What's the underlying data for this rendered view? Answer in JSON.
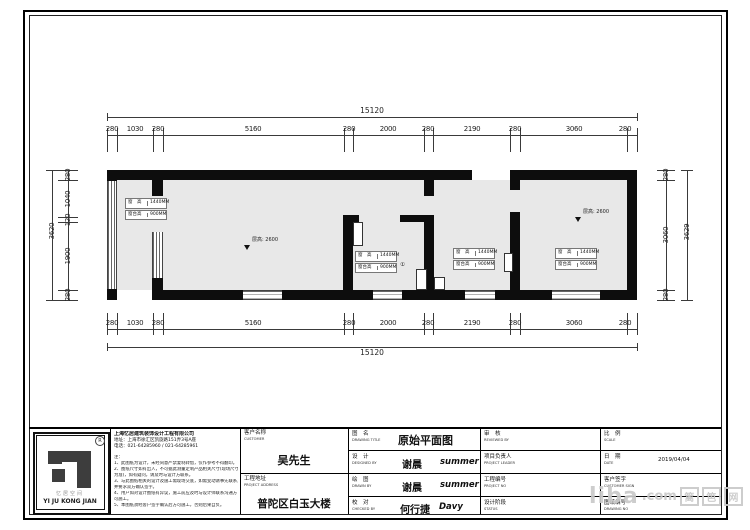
{
  "dims": {
    "h_total": "15120",
    "h_segments": [
      "280",
      "1030",
      "280",
      "5160",
      "280",
      "2000",
      "280",
      "2190",
      "280",
      "3060",
      "280"
    ],
    "v_left_total": "3620",
    "v_left_segments": [
      "280",
      "1040",
      "120",
      "1900",
      "280"
    ],
    "v_right_total": "3629",
    "v_right_segments": [
      "280",
      "3060",
      "280"
    ]
  },
  "plan": {
    "win_h": "窗　高",
    "win_h_val": "1440MM",
    "sill": "窗台高",
    "sill_val": "900MM",
    "ceiling": "层高: 2600",
    "circle": "①"
  },
  "titleblock": {
    "logo": {
      "reg": "R",
      "cn": "忆居空间",
      "en": "YI JU KONG JIAN"
    },
    "company": {
      "name": "上海忆居建筑装饰设计工程有限公司",
      "address": "地址：上海市徐汇区凯旋路151弄3号A座",
      "phone": "电话：021-64285960 / 021-64285961",
      "notes_title": "注：",
      "notes": [
        "1、此图纸为设计，未经同意严禁复制转借，仅作参考不得翻印。",
        "2、图纸尺寸如有出入，不可据此测量定制产品相关尺寸(现场尺寸",
        "为准)，如有疑问，请及时与设计方联系。",
        "3、与此图纸相关的设计及施工需现场交底，如需变动请事先联系，",
        "并要求双方确认签字。",
        "4、用户如对设计图纸有异议，施工前应及时与设计师联系沟通方",
        "可施工。",
        "5、本图纸须经客户签字确认后方可施工，否则后果自负。"
      ]
    },
    "customer": {
      "label_cn": "客户名称",
      "label_en": "CUSTOMER",
      "value": "吴先生"
    },
    "address": {
      "label_cn": "工程地址",
      "label_en": "PROJECT ADDRESS",
      "value": "普陀区白玉大楼"
    },
    "rows": [
      {
        "label_cn": "图　名",
        "label_en": "DRAWING TITLE",
        "value": "原始平面图",
        "value2": ""
      },
      {
        "label_cn": "设　计",
        "label_en": "DESIGNED BY",
        "value": "谢晨",
        "value2": "summer"
      },
      {
        "label_cn": "绘　图",
        "label_en": "DRAWN BY",
        "value": "谢晨",
        "value2": "summer"
      },
      {
        "label_cn": "校　对",
        "label_en": "CHECKED BY",
        "value": "何行捷",
        "value2": "Davy"
      }
    ],
    "col5": [
      {
        "label_cn": "审　核",
        "label_en": "REVIEWED BY"
      },
      {
        "label_cn": "项目负责人",
        "label_en": "PROJECT LEADER"
      },
      {
        "label_cn": "工程编号",
        "label_en": "PROJECT NO"
      },
      {
        "label_cn": "设计阶段",
        "label_en": "STATUS"
      }
    ],
    "col6": [
      {
        "label_cn": "比　例",
        "label_en": "SCALE",
        "value": ""
      },
      {
        "label_cn": "日　期",
        "label_en": "DATE",
        "value": "2019/04/04"
      },
      {
        "label_cn": "客户签字",
        "label_en": "CUSTOMER SIGN",
        "value": ""
      },
      {
        "label_cn": "图纸编号",
        "label_en": "DRAWING NO",
        "value": ""
      }
    ]
  },
  "watermark": {
    "main": "liba",
    "suffix": ".com",
    "cn1": "篱",
    "cn2": "笆",
    "cn3": "网"
  }
}
